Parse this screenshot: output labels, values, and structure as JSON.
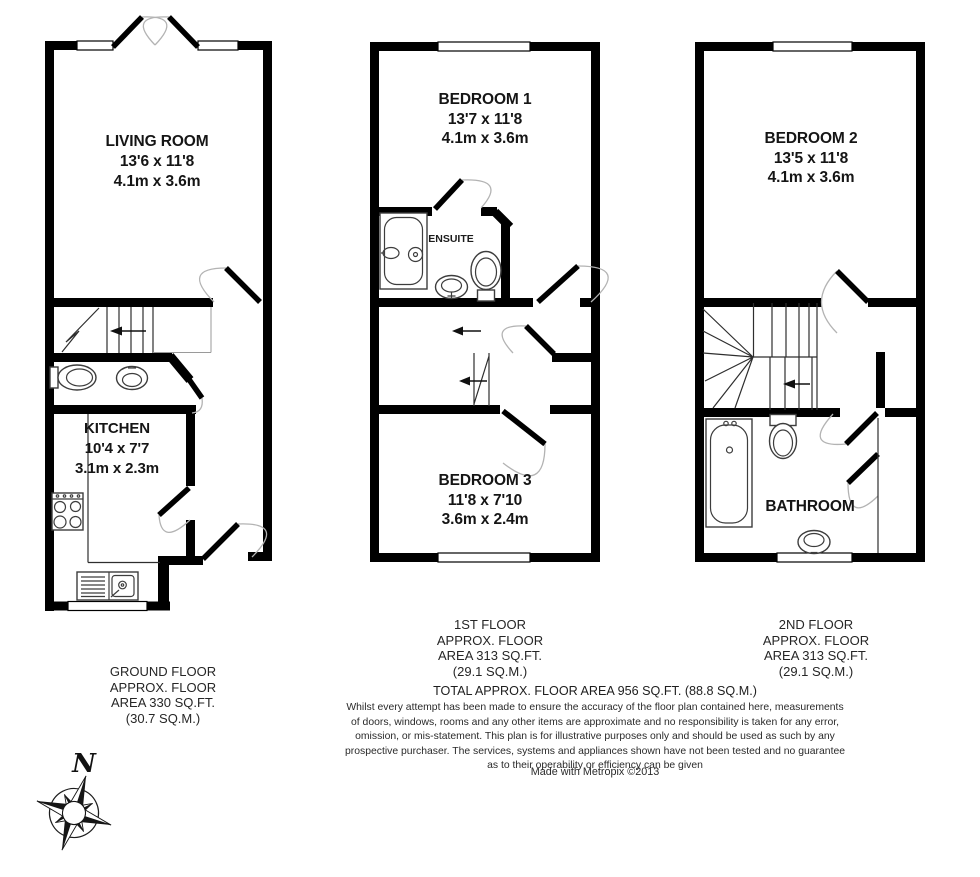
{
  "ground_floor": {
    "rooms": {
      "living_room": {
        "name": "LIVING ROOM",
        "dims_imperial": "13'6 x 11'8",
        "dims_metric": "4.1m x 3.6m"
      },
      "kitchen": {
        "name": "KITCHEN",
        "dims_imperial": "10'4 x 7'7",
        "dims_metric": "3.1m x 2.3m"
      }
    },
    "caption": [
      "GROUND FLOOR",
      "APPROX. FLOOR",
      "AREA 330 SQ.FT.",
      "(30.7 SQ.M.)"
    ]
  },
  "first_floor": {
    "rooms": {
      "bedroom1": {
        "name": "BEDROOM 1",
        "dims_imperial": "13'7 x 11'8",
        "dims_metric": "4.1m x 3.6m"
      },
      "ensuite": {
        "name": "ENSUITE"
      },
      "bedroom3": {
        "name": "BEDROOM 3",
        "dims_imperial": "11'8 x 7'10",
        "dims_metric": "3.6m x 2.4m"
      }
    },
    "caption": [
      "1ST FLOOR",
      "APPROX. FLOOR",
      "AREA 313 SQ.FT.",
      "(29.1 SQ.M.)"
    ]
  },
  "second_floor": {
    "rooms": {
      "bedroom2": {
        "name": "BEDROOM 2",
        "dims_imperial": "13'5 x 11'8",
        "dims_metric": "4.1m x 3.6m"
      },
      "bathroom": {
        "name": "BATHROOM"
      }
    },
    "caption": [
      "2ND FLOOR",
      "APPROX. FLOOR",
      "AREA 313 SQ.FT.",
      "(29.1 SQ.M.)"
    ]
  },
  "summary": {
    "total_area": "TOTAL APPROX. FLOOR AREA 956 SQ.FT. (88.8 SQ.M.)",
    "disclaimer": [
      "Whilst every attempt has been made to ensure the accuracy of the floor plan contained here, measurements",
      "of doors, windows, rooms and any other items are approximate and no responsibility is taken for any error,",
      "omission, or mis-statement. This plan is for illustrative purposes only and should be used as such by any",
      "prospective purchaser. The services, systems and appliances shown have not been tested and no guarantee",
      "as to their operability or efficiency can be given"
    ],
    "credit": "Made with Metropix ©2013"
  },
  "compass": {
    "north_label": "N"
  },
  "colors": {
    "wall": "#000000",
    "door_arc": "#b3b3b3",
    "fixture": "#3d3d3d",
    "text": "#151515",
    "background": "#ffffff"
  }
}
